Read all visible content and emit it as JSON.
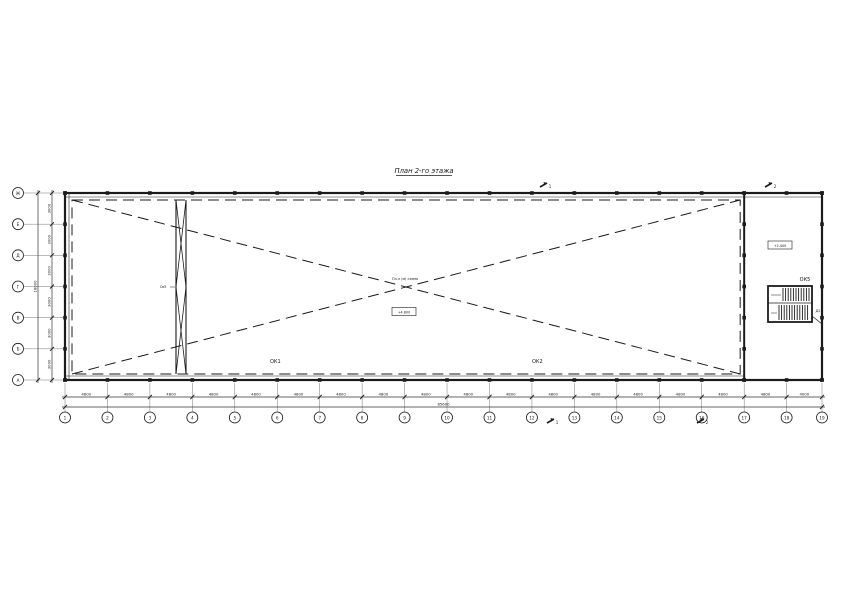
{
  "title": "План 2-го этажа",
  "axes": {
    "columns": [
      "1",
      "2",
      "3",
      "4",
      "5",
      "6",
      "7",
      "8",
      "9",
      "10",
      "11",
      "12",
      "13",
      "14",
      "15",
      "16",
      "17",
      "18",
      "19"
    ],
    "rows": [
      "Ж",
      "Е",
      "Д",
      "Г",
      "В",
      "Б",
      "А"
    ]
  },
  "dimensions": {
    "bays": [
      "4800",
      "4800",
      "4800",
      "4800",
      "4800",
      "4800",
      "4800",
      "4800",
      "4800",
      "4800",
      "4800",
      "4800",
      "4800",
      "4800",
      "4800",
      "4800",
      "4800",
      "4000"
    ],
    "total_width": "85600",
    "rows": [
      "3000",
      "3000",
      "3000",
      "3000",
      "3000",
      "3000"
    ],
    "total_height": "18000"
  },
  "labels": {
    "window1": "ОК1",
    "window2": "ОК2",
    "window5": "ОК5",
    "door": "Д2",
    "brace": "Св5",
    "center_note": "Пл-н (м) схема",
    "center_elevation": "+4.800",
    "stair_elevation": "+2.400"
  },
  "section_marks": [
    "1",
    "2",
    "1",
    "2"
  ]
}
